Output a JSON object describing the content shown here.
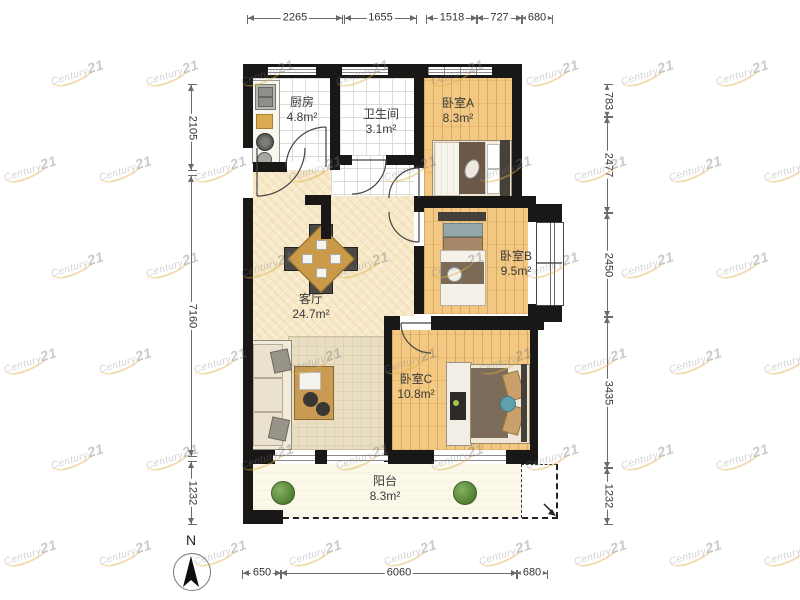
{
  "plan": {
    "rooms": [
      {
        "id": "kitchen",
        "name": "厨房",
        "area": "4.8m²"
      },
      {
        "id": "bathroom",
        "name": "卫生间",
        "area": "3.1m²"
      },
      {
        "id": "bedroomA",
        "name": "卧室A",
        "area": "8.3m²"
      },
      {
        "id": "bedroomB",
        "name": "卧室B",
        "area": "9.5m²"
      },
      {
        "id": "bedroomC",
        "name": "卧室C",
        "area": "10.8m²"
      },
      {
        "id": "living",
        "name": "客厅",
        "area": "24.7m²"
      },
      {
        "id": "balcony",
        "name": "阳台",
        "area": "8.3m²"
      }
    ],
    "compass_label": "N"
  },
  "dimensions": {
    "top": [
      "2265",
      "1655",
      "1518",
      "727",
      "680"
    ],
    "left": [
      "2105",
      "7160",
      "1232"
    ],
    "right": [
      "783",
      "2477",
      "2450",
      "3435",
      "1232"
    ],
    "bottom": [
      "650",
      "6060",
      "680"
    ]
  },
  "watermark": {
    "brand": "Century",
    "number": "21"
  }
}
